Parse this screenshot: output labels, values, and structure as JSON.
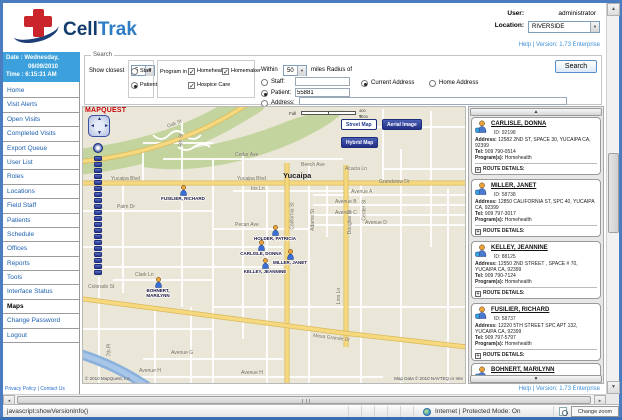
{
  "header": {
    "brand_first": "Cell",
    "brand_second": "Trak",
    "user_label": "User:",
    "user_value": "administrator",
    "location_label": "Location:",
    "location_value": "RIVERSIDE",
    "help_version": "Help | Version: 1.73 Enterprise"
  },
  "icons": {
    "dropdown_arrow": "▼",
    "scroll_up": "▲",
    "scroll_down": "▼",
    "scroll_left": "◄",
    "scroll_right": "►",
    "compass_up": "▲",
    "compass_down": "▼",
    "compass_left": "◄",
    "compass_right": "►",
    "route_expand": "+"
  },
  "sidebar": {
    "date_line1": "Date : Wednesday,",
    "date_line2": "06/09/2010",
    "time_line": "Time : 6:15:31 AM",
    "items": [
      {
        "label": "Home"
      },
      {
        "label": "Visit Alerts"
      },
      {
        "label": "Open Visits"
      },
      {
        "label": "Completed Visits"
      },
      {
        "label": "Export Queue"
      },
      {
        "label": "User List"
      },
      {
        "label": "Roles"
      },
      {
        "label": "Locations"
      },
      {
        "label": "Field Staff"
      },
      {
        "label": "Patients"
      },
      {
        "label": "Schedule"
      },
      {
        "label": "Offices"
      },
      {
        "label": "Reports"
      },
      {
        "label": "Tools"
      },
      {
        "label": "Interface Status"
      },
      {
        "label": "Maps",
        "active": true
      },
      {
        "label": "Change Password"
      },
      {
        "label": "Logout"
      }
    ],
    "footer_link": "Privacy Policy | Contact Us"
  },
  "search": {
    "legend": "Search",
    "show_closest_label": "Show closest",
    "show_closest_value": "5",
    "staff_radio": "Staff",
    "patient_radio": "Patient",
    "program_label": "Program in",
    "programs": [
      {
        "label": "Homehealth",
        "checked": true,
        "x": 30,
        "y": 7
      },
      {
        "label": "Homemaker",
        "checked": true,
        "x": 64,
        "y": 7
      },
      {
        "label": "Hospice Care",
        "checked": true,
        "x": 30,
        "y": 21
      }
    ],
    "within_label": "Within",
    "within_value": "50",
    "radius_label": "miles Radius of",
    "staff_field_label": "Staff:",
    "patient_field_label": "Patient:",
    "patient_field_value": "55881",
    "address_field_label": "Address:",
    "current_address": "Current Address",
    "home_address": "Home Address",
    "button": "Search"
  },
  "map": {
    "logo": "MapQuest",
    "scale_full": "Full",
    "scale_m": "400 m",
    "scale_ft": "1200 ft",
    "view_buttons": [
      {
        "label": "Street Map",
        "active": true
      },
      {
        "label": "Aerial Image"
      },
      {
        "label": "Hybrid Map"
      }
    ],
    "streets": [
      {
        "text": "Oak St",
        "x": 84,
        "y": 14,
        "rot": -22
      },
      {
        "text": "5th St",
        "x": 92,
        "y": 30,
        "rot": -90
      },
      {
        "text": "Cedar Ave",
        "x": 152,
        "y": 45
      },
      {
        "text": "Beech Ave",
        "x": 218,
        "y": 55
      },
      {
        "text": "Acacia Ln",
        "x": 262,
        "y": 59
      },
      {
        "text": "Yucaipa Blvd",
        "x": 28,
        "y": 69
      },
      {
        "text": "Yucaipa Blvd",
        "x": 154,
        "y": 69
      },
      {
        "text": "Yucaipa",
        "x": 200,
        "y": 64,
        "city": true
      },
      {
        "text": "Grandview Dr",
        "x": 296,
        "y": 72
      },
      {
        "text": "Iris Ln",
        "x": 168,
        "y": 79
      },
      {
        "text": "Avenue A",
        "x": 268,
        "y": 82
      },
      {
        "text": "Avenue B",
        "x": 252,
        "y": 92
      },
      {
        "text": "Avenue C",
        "x": 252,
        "y": 103
      },
      {
        "text": "Avenue D",
        "x": 282,
        "y": 113
      },
      {
        "text": "Center St",
        "x": 271,
        "y": 100,
        "rot": -90
      },
      {
        "text": "Adams St",
        "x": 219,
        "y": 110,
        "rot": -90
      },
      {
        "text": "California St",
        "x": 196,
        "y": 106,
        "rot": -90
      },
      {
        "text": "Douglas St",
        "x": 255,
        "y": 112,
        "rot": -90
      },
      {
        "text": "Palm Dr",
        "x": 34,
        "y": 97
      },
      {
        "text": "Pecan Ave",
        "x": 152,
        "y": 115
      },
      {
        "text": "Linn Ln",
        "x": 248,
        "y": 186,
        "rot": -90
      },
      {
        "text": "Clark Ln",
        "x": 52,
        "y": 165
      },
      {
        "text": "Colorado St",
        "x": 5,
        "y": 177
      },
      {
        "text": "Mesa Grande Dr",
        "x": 230,
        "y": 228,
        "rot": 7
      },
      {
        "text": "Avenue G",
        "x": 88,
        "y": 243
      },
      {
        "text": "Avenue H",
        "x": 56,
        "y": 261
      },
      {
        "text": "Avenue H",
        "x": 158,
        "y": 263
      },
      {
        "text": "7th Pl",
        "x": 20,
        "y": 240,
        "rot": -90
      }
    ],
    "markers": [
      {
        "name": "FUSILIER, RICHARD",
        "x": 100,
        "y": 88
      },
      {
        "name": "HOLDER, PATRICIA",
        "x": 192,
        "y": 128
      },
      {
        "name": "CARLISLE, DONNA",
        "x": 178,
        "y": 143
      },
      {
        "name": "MILLER, JANET",
        "x": 207,
        "y": 152
      },
      {
        "name": "KELLEY, JEANNINE",
        "x": 182,
        "y": 161
      },
      {
        "name": "BOHNERT, MARILYNN",
        "x": 75,
        "y": 180
      }
    ],
    "attribution_left": "© 2010 MapQuest, Inc.",
    "attribution_right": "Map Data © 2010 NAVTEQ or Inte"
  },
  "results": {
    "labels": {
      "address": "Address:",
      "tel": "Tel:",
      "program": "Program(s):",
      "route": "ROUTE DETAILS:"
    },
    "patients": [
      {
        "name": "CARLISLE, DONNA",
        "id": "ID:  92198",
        "address": "12582 2ND ST, SPACE 30, YUCAIPA CA, 92399",
        "tel": "909 790-0514",
        "program": "Homehealth",
        "x": 2,
        "y": 10
      },
      {
        "name": "MILLER, JANET",
        "id": "ID:  58738",
        "address": "12850 CALIFORNIA ST, SPC 40, YUCAIPA CA, 92399",
        "tel": "909 797-3017",
        "program": "Homehealth",
        "x": 2,
        "y": 72
      },
      {
        "name": "KELLEY, JEANNINE",
        "id": "ID:  88125",
        "address": "12550 2ND STREET , SPACE # 70, YUCAIPA CA, 92399",
        "tel": "909 790-7124",
        "program": "Homehealth",
        "x": 2,
        "y": 134
      },
      {
        "name": "FUSILIER, RICHARD",
        "id": "ID:  58737",
        "address": "12220 5TH STREET SPC APT 132, YUCAIPA CA, 92399",
        "tel": "909 797-5797",
        "program": "Homehealth",
        "x": 2,
        "y": 196
      },
      {
        "name": "BOHNERT, MARILYNN",
        "id": "ID:  55591",
        "address": "12010 5TH STREET, SB-74, YUCAIPA CA, 92399",
        "tel": "",
        "program": "Homehealth",
        "x": 2,
        "y": 256
      }
    ]
  },
  "footer": {
    "help_version": "Help | Version: 1.73 Enterprise"
  },
  "statusbar": {
    "script_text": "javascript:showVersionInfo()",
    "zone_text": "Internet | Protected Mode: On",
    "zoom_text": "Change zoom level"
  }
}
